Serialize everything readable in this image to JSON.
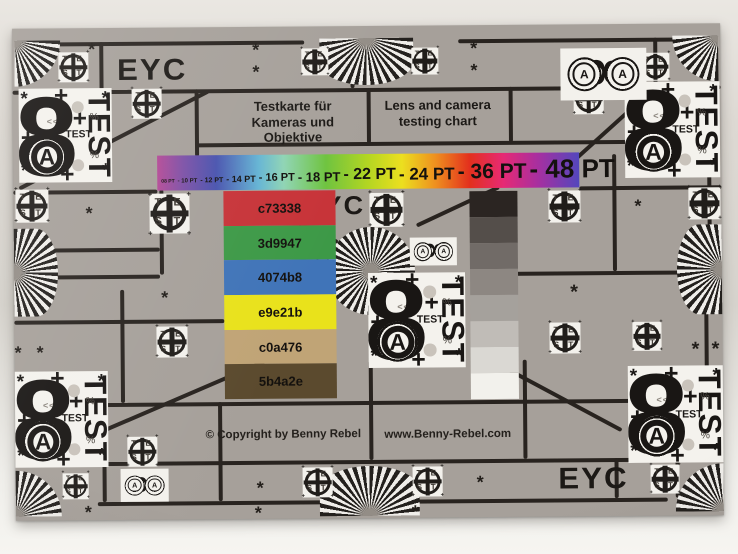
{
  "chart": {
    "eyc_label": "EYC",
    "title_de": "Testkarte für\nKameras und Objektive",
    "title_en": "Lens and camera\ntesting chart",
    "copyright": "© Copyright by Benny Rebel",
    "website": "www.Benny-Rebel.com"
  },
  "pt_scale": {
    "items": [
      {
        "label": "08 PT",
        "size": "5px"
      },
      {
        "label": "- 10 PT",
        "size": "6px"
      },
      {
        "label": "- 12 PT",
        "size": "7px"
      },
      {
        "label": "- 14 PT",
        "size": "9px"
      },
      {
        "label": "- 16 PT",
        "size": "11px"
      },
      {
        "label": "- 18 PT",
        "size": "13px"
      },
      {
        "label": "- 22 PT",
        "size": "16px"
      },
      {
        "label": "- 24 PT",
        "size": "17px"
      },
      {
        "label": "- 36 PT",
        "size": "21px"
      },
      {
        "label": "- 48 PT",
        "size": "26px"
      }
    ]
  },
  "swatches": [
    {
      "label": "c73338",
      "color": "#c73338"
    },
    {
      "label": "3d9947",
      "color": "#3d9947"
    },
    {
      "label": "4074b8",
      "color": "#4074b8"
    },
    {
      "label": "e9e21b",
      "color": "#e9e21b"
    },
    {
      "label": "c0a476",
      "color": "#c0a476"
    },
    {
      "label": "5b4a2e",
      "color": "#5b4a2e"
    }
  ],
  "grayscale": {
    "steps": [
      {
        "color": "#2b2522"
      },
      {
        "color": "#544e4a"
      },
      {
        "color": "#716b67"
      },
      {
        "color": "#8d8782"
      },
      {
        "color": "#a5a19c"
      },
      {
        "color": "#c0bcb7"
      },
      {
        "color": "#dad8d3"
      },
      {
        "color": "#f2f1ec"
      }
    ]
  },
  "test_block": {
    "digit": "8",
    "letter": "A",
    "vertical_label": "TEST",
    "small_label": "TEST",
    "percent": "%",
    "micro_left": "<<<",
    "micro_right": "vvv"
  },
  "reg_mark": {
    "t1": "T",
    "t2": "E",
    "b1": "S",
    "b2": "T"
  },
  "glyphs": {
    "asterisk": "*",
    "plus": "+"
  },
  "colors": {
    "chart_gray": "#a6a09a",
    "ink": "#1c1916",
    "paper_white": "#f3f1ec"
  }
}
